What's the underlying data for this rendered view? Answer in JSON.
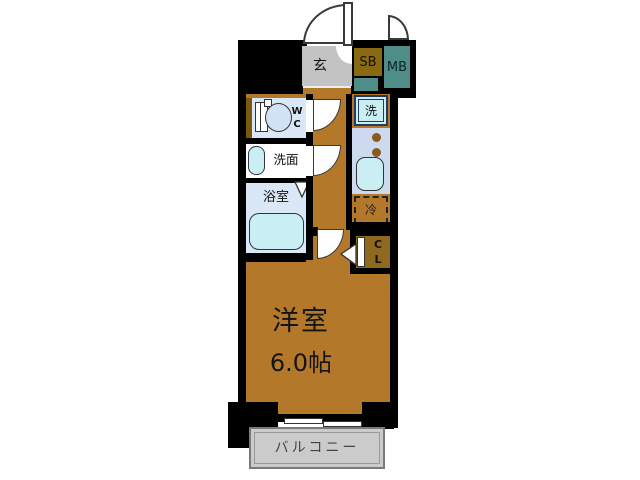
{
  "plan": {
    "entrance": {
      "label": "玄"
    },
    "shoe_box": {
      "label": "SB"
    },
    "meter_box": {
      "label": "MB"
    },
    "toilet": {
      "label_line1": "W",
      "label_line2": "C"
    },
    "washroom": {
      "label": "洗面"
    },
    "bathroom": {
      "label": "浴室"
    },
    "washer": {
      "label": "洗"
    },
    "fridge": {
      "label": "冷"
    },
    "closet": {
      "label_line1": "C",
      "label_line2": "L"
    },
    "main_room": {
      "name": "洋室",
      "size": "6.0帖"
    },
    "balcony": {
      "label": "バルコニー"
    }
  },
  "colors": {
    "wall": "#000000",
    "floor": "#b3782a",
    "genkan": "#c3c3c3",
    "roomblue": "#d9e7f6",
    "counter": "#ccd9ee",
    "cyan": "#c9eef3",
    "teal": "#4f8d88",
    "olive": "#8a6a10",
    "clbrown": "#8f6a1e",
    "balcony": "#cbcbcb",
    "burner": "#8a5a1e"
  }
}
